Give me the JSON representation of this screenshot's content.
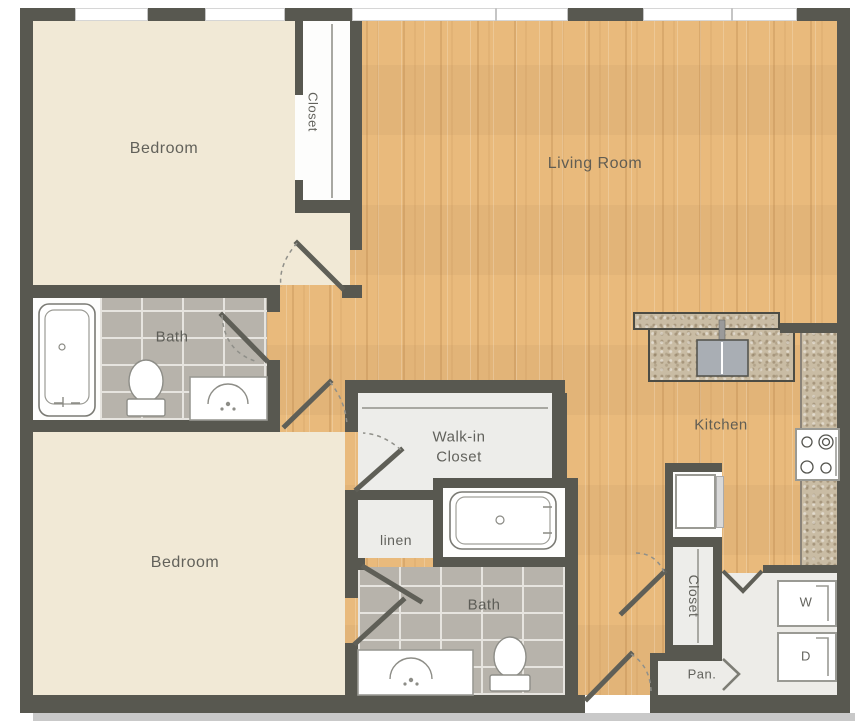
{
  "rooms": {
    "bedroom_top": {
      "label": "Bedroom"
    },
    "closet_bedroom_top": {
      "label": "Closet"
    },
    "living_room": {
      "label": "Living Room"
    },
    "bath_top": {
      "label": "Bath"
    },
    "bedroom_bottom": {
      "label": "Bedroom"
    },
    "walk_in_closet": {
      "label": "Walk-in Closet"
    },
    "linen": {
      "label": "linen"
    },
    "bath_bottom": {
      "label": "Bath"
    },
    "kitchen": {
      "label": "Kitchen"
    },
    "closet_hall": {
      "label": "Closet"
    },
    "pantry": {
      "label": "Pan."
    },
    "washer": {
      "label": "W"
    },
    "dryer": {
      "label": "D"
    }
  },
  "colors": {
    "wall": "#585850",
    "bedroom_floor": "#f1e9d6",
    "wood_floor": "#e9ba7c",
    "tile_floor": "#b7b3ab",
    "counter_granite": "#c9bca4",
    "closet_floor": "#ededea",
    "laundry_floor": "#edece8",
    "label_text": "#565650",
    "shadow": "#c9c9c9",
    "sink_steel": "#a9aeb4"
  }
}
